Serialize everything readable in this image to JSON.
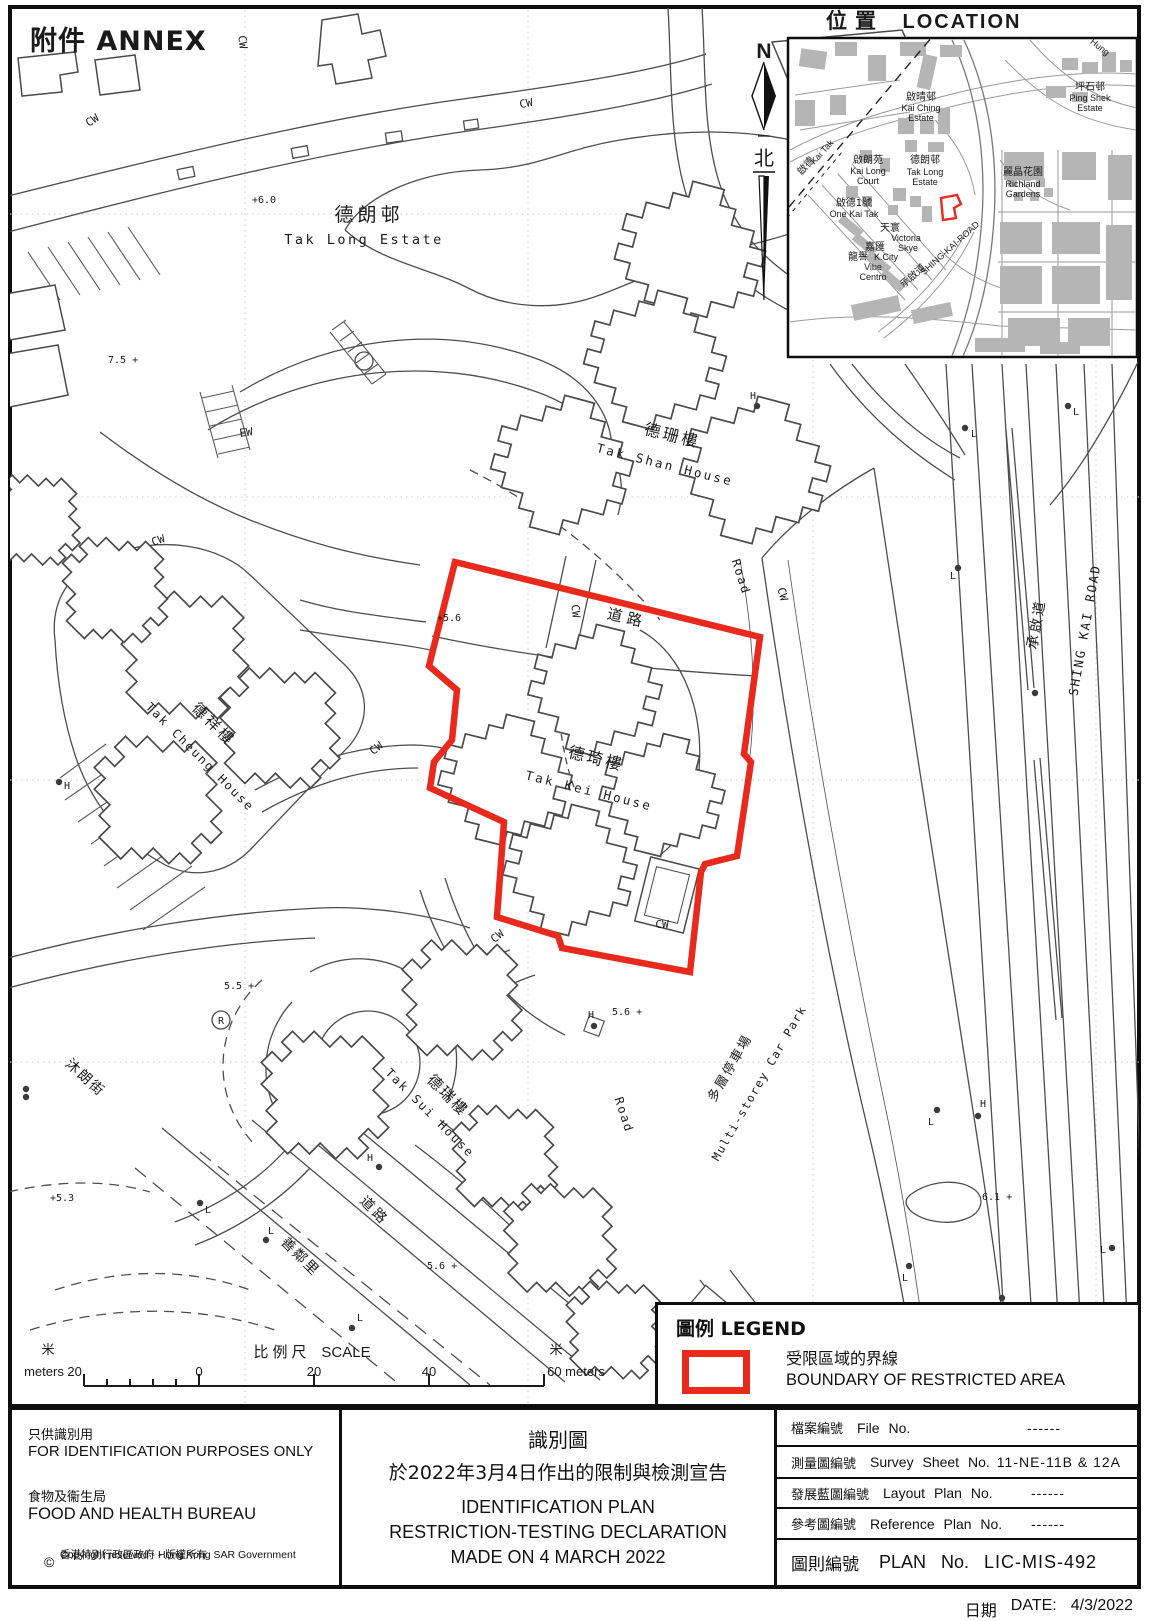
{
  "annex_title": "附件 ANNEX",
  "inset": {
    "title_zh": "位置",
    "title_en": "LOCATION",
    "north_letter": "N",
    "north_zh": "北",
    "labels": {
      "kai_ching_zh": "啟晴邨",
      "kai_ching_en1": "Kai Ching",
      "kai_ching_en2": "Estate",
      "ping_shek_zh": "坪石邨",
      "ping_shek_en1": "Ping Shek",
      "ping_shek_en2": "Estate",
      "hung": "Hung",
      "kai_long_zh": "啟朗苑",
      "kai_long_en1": "Kai Long",
      "kai_long_en2": "Court",
      "tak_long_zh": "德朗邨",
      "tak_long_en1": "Tak Long",
      "tak_long_en2": "Estate",
      "richland_zh": "麗晶花園",
      "richland_en1": "Richland",
      "richland_en2": "Gardens",
      "one_kai_tak_zh": "啟德1號",
      "one_kai_tak_en": "One Kai Tak",
      "victoria_skye_zh": "天寰",
      "victoria_skye_en1": "Victoria",
      "victoria_skye_en2": "Skye",
      "k_city_zh": "嘉匯",
      "k_city_en": "K.City",
      "vibe_centro_zh": "龍譽",
      "vibe_centro_en1": "Vibe",
      "vibe_centro_en2": "Centro",
      "shing_kai_zh": "承啟道",
      "shing_kai_en": "SHING-KAI-ROAD",
      "kai_tak_zh": "啟德",
      "kai_tak_en": "Kai Tak"
    }
  },
  "map": {
    "tak_long_zh": "德朗邨",
    "tak_long_en": "Tak Long Estate",
    "tak_shan_zh": "德珊樓",
    "tak_shan_en": "Tak Shan House",
    "tak_kei_zh": "德琦樓",
    "tak_kei_en": "Tak Kei House",
    "tak_cheung_zh": "德祥樓",
    "tak_cheung_en": "Tak Cheung House",
    "tak_sui_zh": "德瑞樓",
    "tak_sui_en": "Tak Sui House",
    "road_zh": "道路",
    "road_en": "Road",
    "muk_long_street_zh": "沐朗街",
    "sin_lun_lane_zh": "善鄰里",
    "carpark_zh": "多層停車場",
    "carpark_en": "Multi-storey Car Park",
    "shing_kai_road_zh": "承啟道",
    "shing_kai_road_en": "SHING KAI ROAD",
    "cw": "CW",
    "ew": "EW",
    "h": "H",
    "l": "L",
    "r": "R",
    "spot_heights": [
      "+6.0",
      "7.5 +",
      "+5.6",
      "5.5 +",
      "+5.3",
      "5.6 +",
      "5.6 +",
      "6.1 +"
    ]
  },
  "scalebar": {
    "meters_zh_left": "米",
    "meters_zh_right": "米",
    "scale_zh": "比例尺",
    "scale_en": "SCALE",
    "label_left": "meters 20",
    "tick_0": "0",
    "tick_20": "20",
    "tick_40": "40",
    "label_right": "60 meters"
  },
  "legend": {
    "title": "圖例 LEGEND",
    "boundary_zh": "受限區域的界線",
    "boundary_en": "BOUNDARY OF RESTRICTED AREA"
  },
  "titleblock": {
    "left": {
      "id_zh": "只供識別用",
      "id_en": "FOR IDENTIFICATION PURPOSES ONLY",
      "bureau_zh": "食物及衞生局",
      "bureau_en": "FOOD AND HEALTH BUREAU",
      "copyright_symbol": "©",
      "copyright_zh": "香港特別行政區政府 - 版權所有",
      "copyright_en": "Copyright reserved - Hong Kong SAR Government"
    },
    "center": {
      "title_zh": "識別圖",
      "subtitle_zh": "於2022年3月4日作出的限制與檢測宣告",
      "title_en": "IDENTIFICATION PLAN",
      "line2_en": "RESTRICTION-TESTING DECLARATION",
      "line3_en": "MADE ON 4 MARCH 2022"
    },
    "rows": [
      {
        "zh": "檔案編號",
        "en": "File No.",
        "value": "------"
      },
      {
        "zh": "測量圖編號",
        "en": "Survey Sheet No.",
        "value": "11-NE-11B & 12A"
      },
      {
        "zh": "發展藍圖編號",
        "en": "Layout Plan No.",
        "value": "------"
      },
      {
        "zh": "參考圖編號",
        "en": "Reference Plan No.",
        "value": "------"
      },
      {
        "zh": "圖則編號",
        "en": "PLAN No.",
        "value": "LIC-MIS-492"
      }
    ]
  },
  "dateline": {
    "zh": "日期",
    "en": "DATE:",
    "value": "4/3/2022"
  },
  "colors": {
    "boundary_red": "#e8291c",
    "inset_building_gray": "#b5b5b5",
    "linework": "#4a4a4a"
  }
}
